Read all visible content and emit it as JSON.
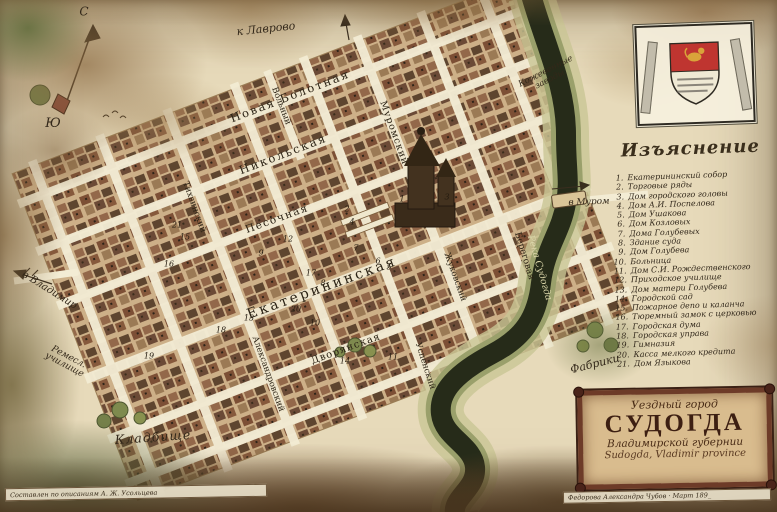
{
  "compass": {
    "north": "С",
    "south": "Ю"
  },
  "legend": {
    "header": "Изъяснение",
    "items": [
      {
        "num": "1.",
        "label": "Екатерининский собор"
      },
      {
        "num": "2.",
        "label": "Торговые ряды"
      },
      {
        "num": "3.",
        "label": "Дом городского головы"
      },
      {
        "num": "4.",
        "label": "Дом А.И. Поспелова"
      },
      {
        "num": "5.",
        "label": "Дом Ушакова"
      },
      {
        "num": "6.",
        "label": "Дом Козловых"
      },
      {
        "num": "7.",
        "label": "Дома Голубевых"
      },
      {
        "num": "8.",
        "label": "Здание суда"
      },
      {
        "num": "9.",
        "label": "Дом Голубева"
      },
      {
        "num": "10.",
        "label": "Больница"
      },
      {
        "num": "11.",
        "label": "Дом С.И. Рождественского"
      },
      {
        "num": "12.",
        "label": "Приходское училище"
      },
      {
        "num": "13.",
        "label": "Дом матери Голубева"
      },
      {
        "num": "14.",
        "label": "Городской сад"
      },
      {
        "num": "15.",
        "label": "Пожарное депо и каланча"
      },
      {
        "num": "16.",
        "label": "Тюремный замок с церковью"
      },
      {
        "num": "17.",
        "label": "Городская дума"
      },
      {
        "num": "18.",
        "label": "Городская управа"
      },
      {
        "num": "19.",
        "label": "Гимназия"
      },
      {
        "num": "20.",
        "label": "Касса мелкого кредита"
      },
      {
        "num": "21.",
        "label": "Дом Языкова"
      }
    ]
  },
  "streets": [
    {
      "name": "Новая Болотная"
    },
    {
      "name": "Никольская"
    },
    {
      "name": "Песочная"
    },
    {
      "name": "Екатерининская"
    },
    {
      "name": "Дворянская"
    },
    {
      "name": "Вольный"
    },
    {
      "name": "Муромский"
    },
    {
      "name": "Тихвинский"
    },
    {
      "name": "Александровский"
    },
    {
      "name": "Жуковский"
    },
    {
      "name": "Успенский"
    },
    {
      "name": "Береговая"
    }
  ],
  "places": [
    {
      "name": "к Лаврово"
    },
    {
      "name": "Кожевенные\nзаводы"
    },
    {
      "name": "в Муром"
    },
    {
      "name": "в Владимир"
    },
    {
      "name": "Ремесл.\nучилище"
    },
    {
      "name": "Кладбище"
    },
    {
      "name": "Фабрики"
    },
    {
      "name": "Река Судогда"
    }
  ],
  "map_numbers": [
    "1",
    "2",
    "3",
    "4",
    "5",
    "6",
    "7",
    "8",
    "9",
    "10",
    "11",
    "12",
    "13",
    "14",
    "15",
    "16",
    "17",
    "18",
    "19",
    "20",
    "21"
  ],
  "title_cartouche": {
    "subtitle_top": "Уездный город",
    "city_name": "СУДОГДА",
    "subtitle_bottom": "Владимирской губернии",
    "subtitle_latin": "Sudogda, Vladimir province"
  },
  "captions": {
    "left": "Составлен по описаниям А. Ж. Усольцева",
    "right": "Федорова Александра Чубов · Март 189_"
  },
  "colors": {
    "parchment": "#e7daba",
    "river": "#262b19",
    "ink": "#33281a",
    "shield_red": "#bf3530",
    "cartouche_frame": "#6d3b28"
  }
}
